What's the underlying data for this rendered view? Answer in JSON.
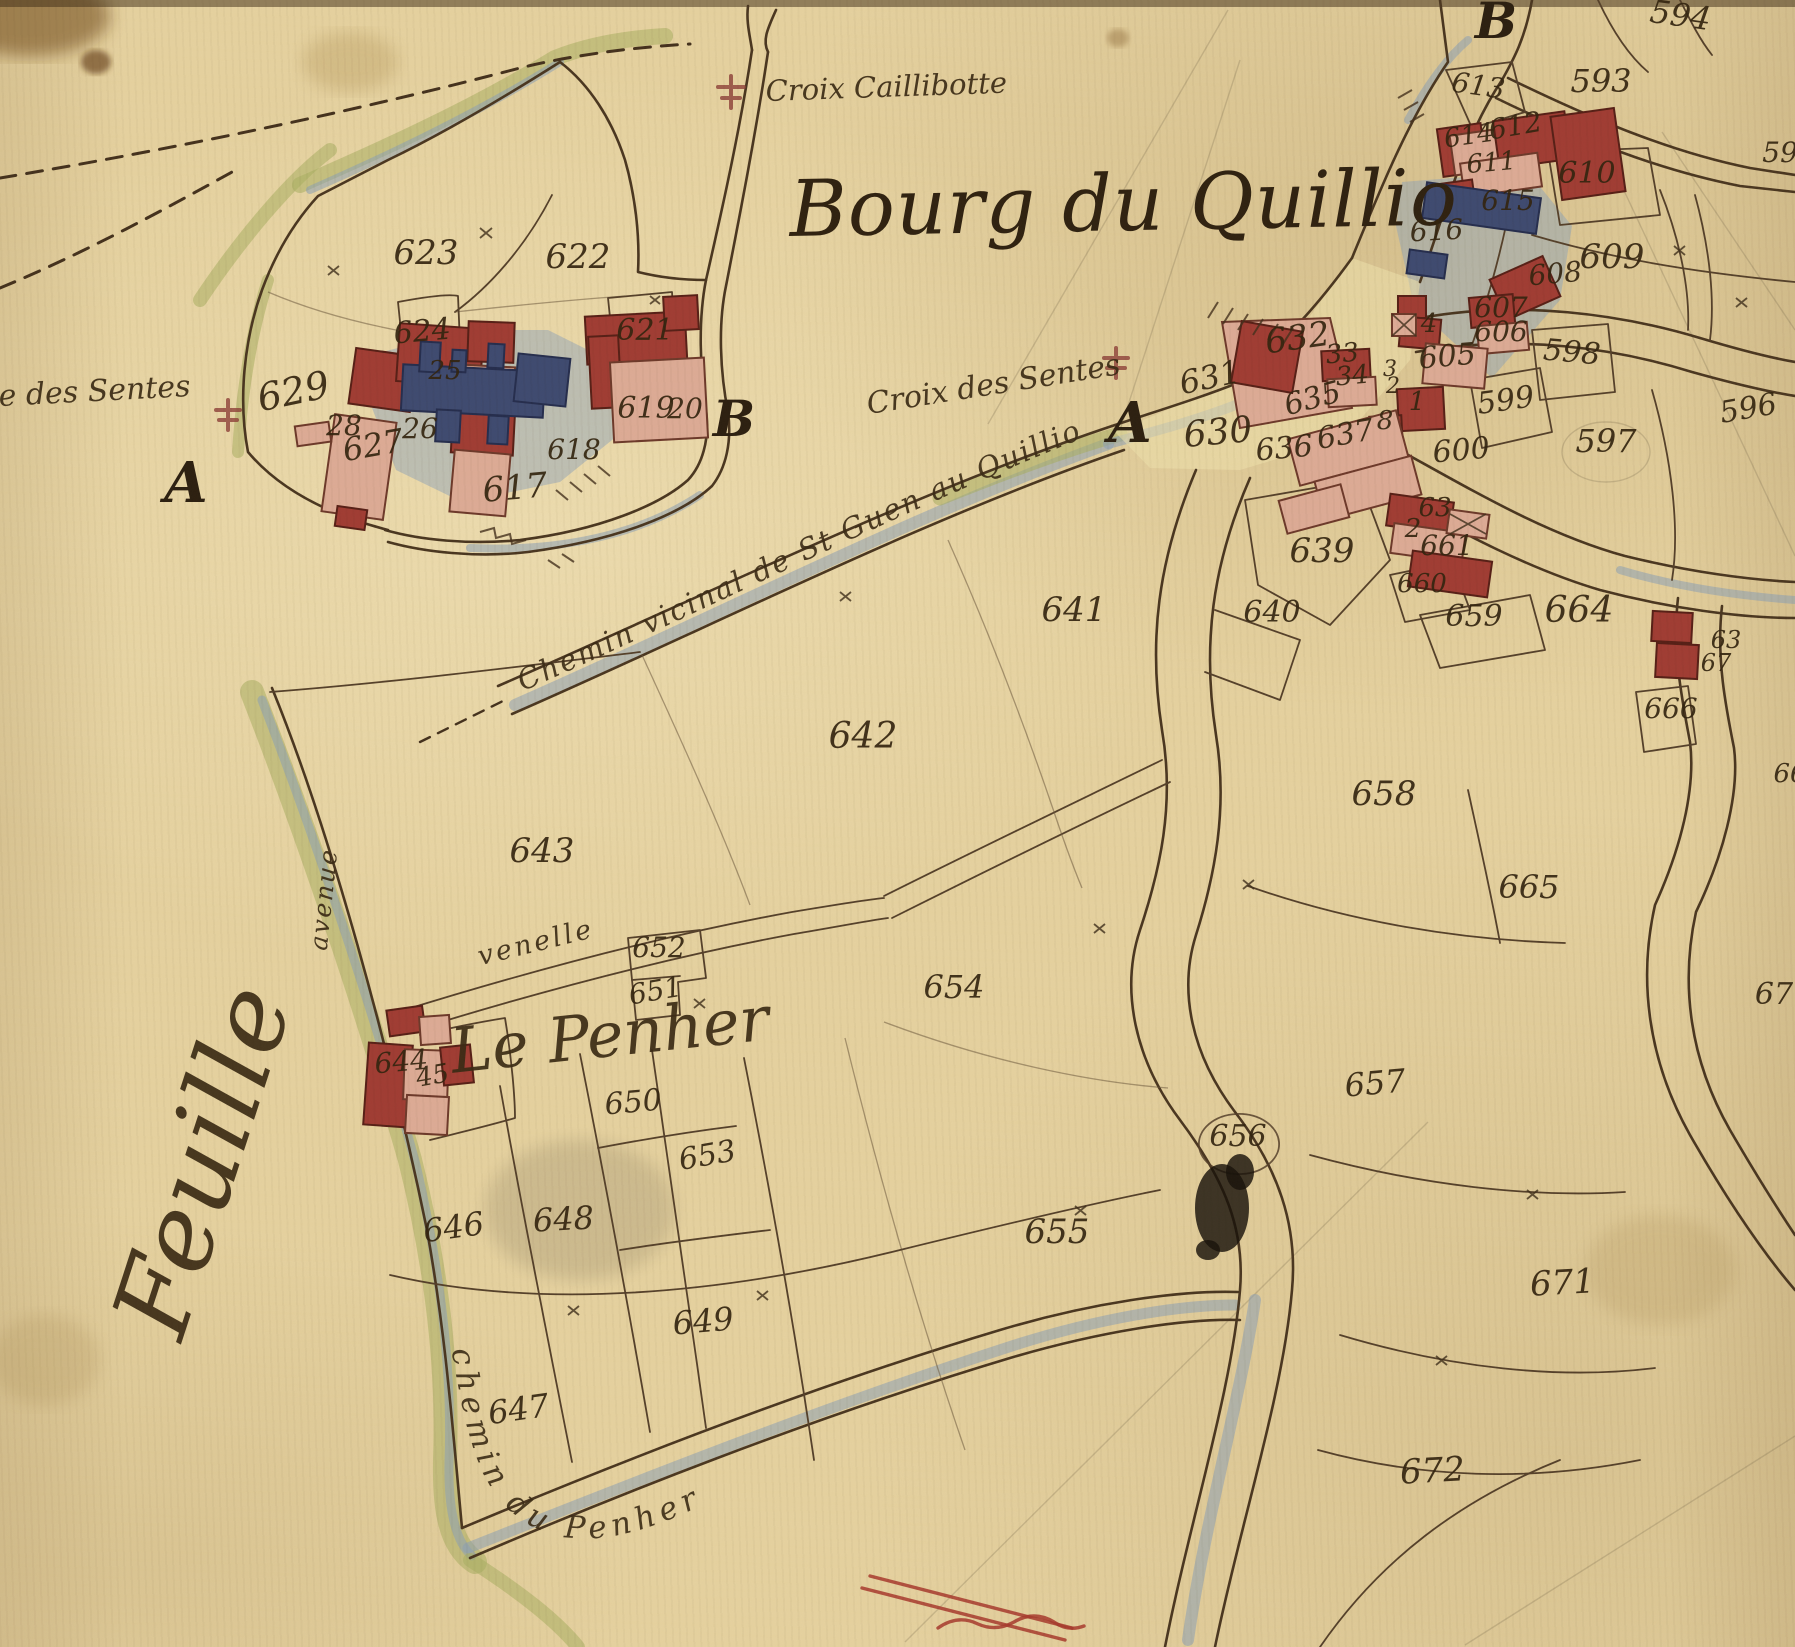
{
  "title": "Bourg du Quillio",
  "map": {
    "colors": {
      "paper": "#e6d2a0",
      "ink": "#33240f",
      "boundary_line": "#4a3620",
      "building_red": "#a03c33",
      "building_pink": "#ddab96",
      "building_blue": "#3e4a70",
      "wash_blue": "#90a4ba",
      "wash_green": "#a9ae62",
      "annotation_red": "#a8392d"
    },
    "landmarks": {
      "croix_caillibotte": "Croix Caillibotte",
      "croix_des_sentes": "Croix des Sentes",
      "croix_des_sentes_partial": "e des Sentes",
      "chemin_vicinal": "Chemin vicinal de St Guen au Quillio",
      "chemin_du_penher": "chemin du Penher",
      "venelle": "venelle",
      "avenue": "avenue",
      "le_penher": "Le Penher",
      "feuille": "Feuille"
    },
    "section_letters": [
      [
        "A",
        186,
        502,
        56
      ],
      [
        "B",
        734,
        436,
        50
      ],
      [
        "A",
        1130,
        442,
        56
      ],
      [
        "B",
        1496,
        38,
        50
      ]
    ],
    "parcel_labels": [
      [
        "623",
        426,
        264,
        34,
        0
      ],
      [
        "622",
        578,
        268,
        34,
        0
      ],
      [
        "624",
        423,
        341,
        30,
        -5
      ],
      [
        "25",
        445,
        379,
        26,
        0
      ],
      [
        "621",
        645,
        340,
        30,
        0
      ],
      [
        "629",
        296,
        404,
        38,
        -12
      ],
      [
        "28",
        344,
        435,
        28,
        0
      ],
      [
        "627",
        375,
        456,
        32,
        -10
      ],
      [
        "26",
        420,
        438,
        28,
        0
      ],
      [
        "619",
        646,
        418,
        30,
        0
      ],
      [
        "20",
        685,
        418,
        28,
        0
      ],
      [
        "618",
        574,
        459,
        28,
        0
      ],
      [
        "617",
        516,
        499,
        34,
        -5
      ],
      [
        "613",
        1477,
        95,
        28,
        8
      ],
      [
        "593",
        1601,
        92,
        32,
        0
      ],
      [
        "594",
        1679,
        26,
        32,
        8
      ],
      [
        "595",
        1789,
        162,
        28,
        0
      ],
      [
        "614",
        1470,
        144,
        26,
        -8
      ],
      [
        "612",
        1517,
        135,
        28,
        -10
      ],
      [
        "611",
        1492,
        171,
        26,
        -5
      ],
      [
        "610",
        1587,
        183,
        30,
        0
      ],
      [
        "615",
        1508,
        210,
        28,
        0
      ],
      [
        "616",
        1437,
        240,
        28,
        -3
      ],
      [
        "609",
        1612,
        268,
        34,
        0
      ],
      [
        "608",
        1556,
        283,
        28,
        -5
      ],
      [
        "607",
        1501,
        317,
        28,
        0
      ],
      [
        "606",
        1501,
        341,
        28,
        0
      ],
      [
        "4",
        1429,
        332,
        26,
        0
      ],
      [
        "605",
        1448,
        366,
        30,
        -5
      ],
      [
        "632",
        1299,
        349,
        34,
        -8
      ],
      [
        "33",
        1343,
        362,
        26,
        -5
      ],
      [
        "34",
        1353,
        384,
        26,
        -5
      ],
      [
        "3",
        1390,
        376,
        22,
        0
      ],
      [
        "2",
        1393,
        393,
        22,
        0
      ],
      [
        "1",
        1417,
        410,
        26,
        0
      ],
      [
        "8",
        1385,
        429,
        26,
        0
      ],
      [
        "631",
        1212,
        388,
        32,
        -12
      ],
      [
        "630",
        1219,
        444,
        36,
        -5
      ],
      [
        "635",
        1315,
        408,
        30,
        -15
      ],
      [
        "636",
        1285,
        458,
        30,
        -5
      ],
      [
        "637",
        1347,
        444,
        30,
        -10
      ],
      [
        "600",
        1462,
        460,
        30,
        -5
      ],
      [
        "599",
        1507,
        410,
        30,
        -8
      ],
      [
        "598",
        1571,
        362,
        30,
        5
      ],
      [
        "597",
        1606,
        452,
        32,
        0
      ],
      [
        "596",
        1750,
        418,
        30,
        -10
      ],
      [
        "639",
        1322,
        562,
        34,
        0
      ],
      [
        "640",
        1272,
        622,
        30,
        0
      ],
      [
        "63",
        1435,
        516,
        26,
        0
      ],
      [
        "2",
        1413,
        537,
        26,
        0
      ],
      [
        "661",
        1447,
        555,
        28,
        0
      ],
      [
        "660",
        1422,
        592,
        26,
        0
      ],
      [
        "659",
        1474,
        626,
        30,
        0
      ],
      [
        "664",
        1579,
        622,
        36,
        0
      ],
      [
        "63",
        1726,
        648,
        24,
        0
      ],
      [
        "67",
        1716,
        671,
        24,
        0
      ],
      [
        "666",
        1671,
        718,
        28,
        0
      ],
      [
        "66",
        1790,
        782,
        26,
        0
      ],
      [
        "658",
        1384,
        805,
        34,
        0
      ],
      [
        "665",
        1529,
        898,
        32,
        0
      ],
      [
        "67",
        1774,
        1004,
        30,
        0
      ],
      [
        "657",
        1376,
        1094,
        32,
        -5
      ],
      [
        "656",
        1238,
        1146,
        30,
        0
      ],
      [
        "655",
        1057,
        1243,
        34,
        0
      ],
      [
        "654",
        954,
        998,
        32,
        0
      ],
      [
        "641",
        1074,
        621,
        34,
        0
      ],
      [
        "642",
        863,
        748,
        36,
        0
      ],
      [
        "643",
        542,
        862,
        34,
        0
      ],
      [
        "652",
        659,
        957,
        28,
        0
      ],
      [
        "651",
        657,
        1000,
        28,
        -10
      ],
      [
        "650",
        634,
        1112,
        30,
        -5
      ],
      [
        "653",
        709,
        1165,
        30,
        -10
      ],
      [
        "644",
        402,
        1071,
        28,
        -5
      ],
      [
        "45",
        434,
        1084,
        26,
        -10
      ],
      [
        "646",
        455,
        1238,
        32,
        -8
      ],
      [
        "648",
        564,
        1230,
        32,
        -3
      ],
      [
        "649",
        704,
        1332,
        32,
        -5
      ],
      [
        "647",
        520,
        1420,
        32,
        -8
      ],
      [
        "671",
        1563,
        1294,
        34,
        -3
      ],
      [
        "672",
        1433,
        1482,
        34,
        -3
      ]
    ]
  }
}
